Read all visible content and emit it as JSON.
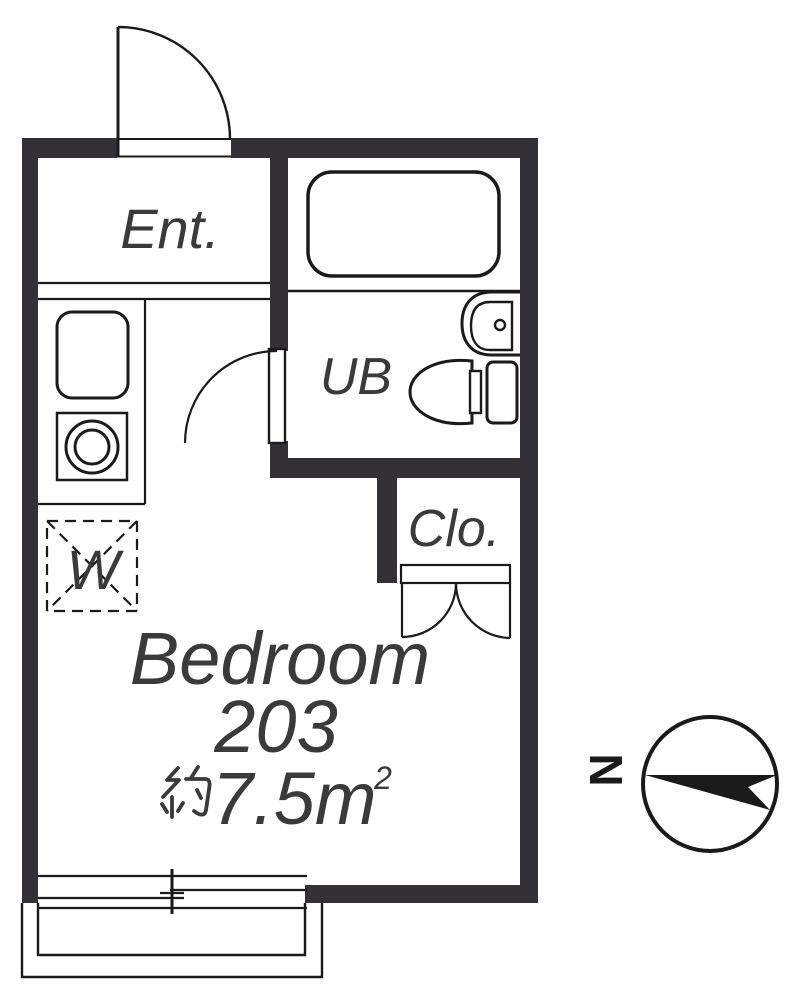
{
  "title": "Floor plan unit 203",
  "colors": {
    "wall": "#333135",
    "line": "#1a1a1a",
    "text": "#3a3a3a",
    "background": "#ffffff"
  },
  "rooms": {
    "entrance": "Ent.",
    "unit_bath": "UB",
    "closet": "Clo.",
    "washer": "W"
  },
  "bedroom": {
    "name": "Bedroom",
    "unit_number": "203",
    "area_full": "約7.5m²",
    "area_kanji": "約",
    "area_figure": "7.5m",
    "area_sup": "2"
  },
  "compass": {
    "north_label": "N"
  }
}
